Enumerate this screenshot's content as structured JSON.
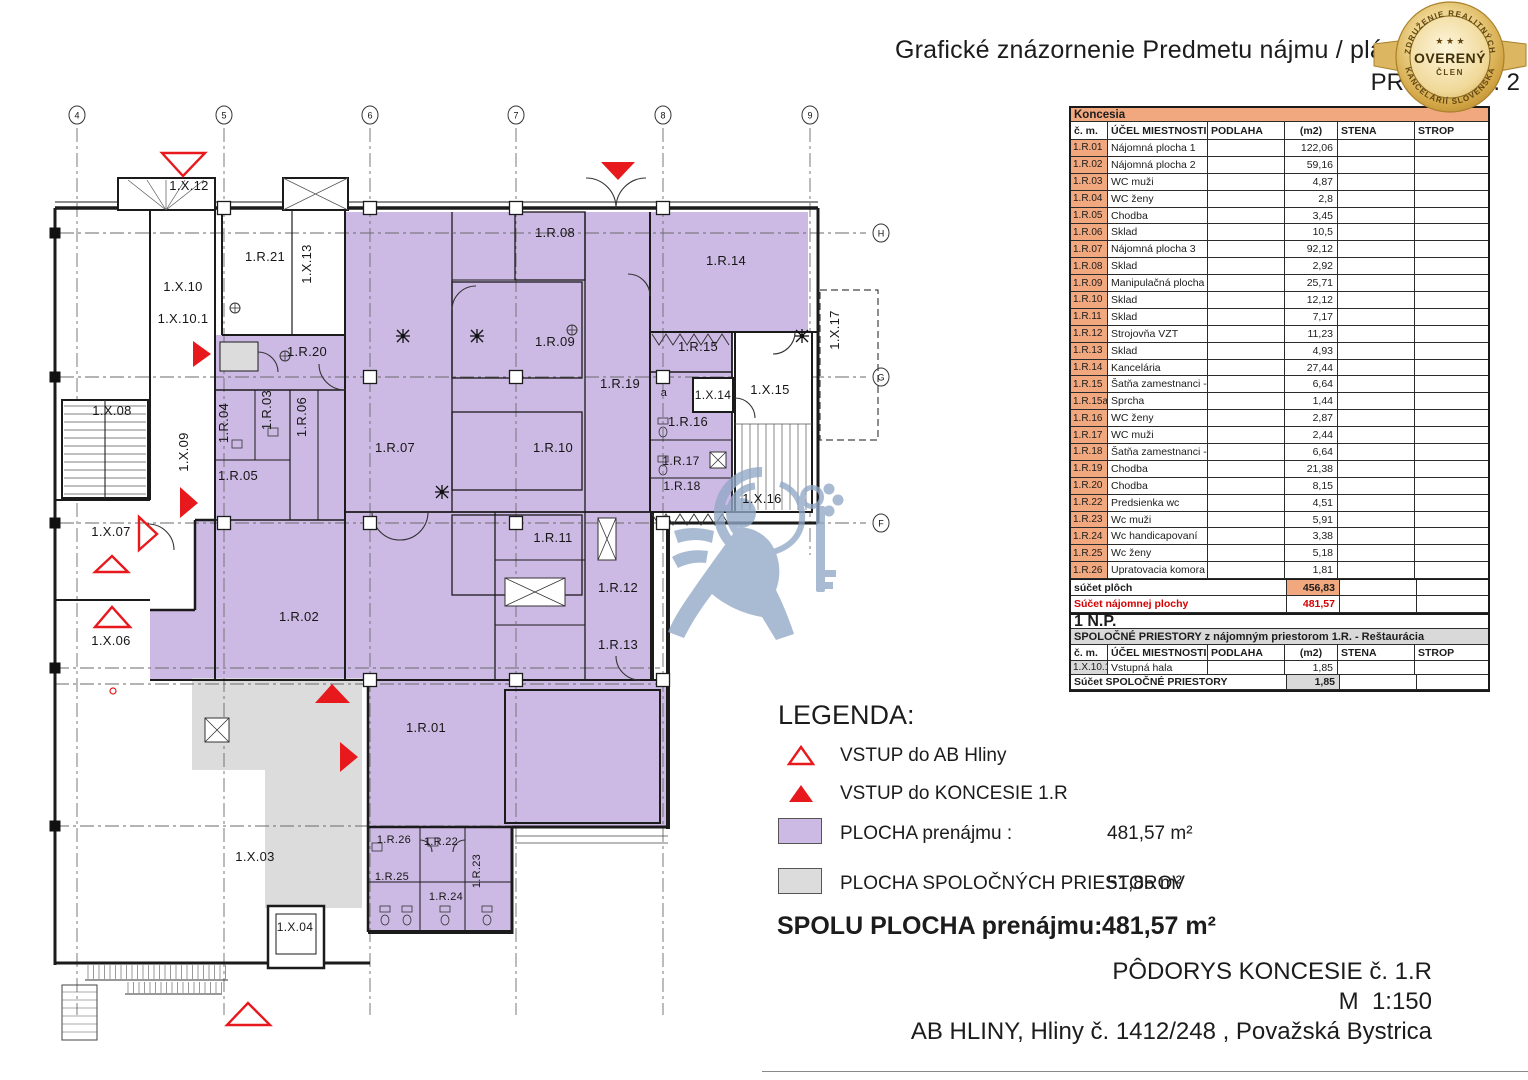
{
  "header": {
    "title": "Grafické znázornenie Predmetu nájmu / plán",
    "attachment": "PRÍLOHA č. 2"
  },
  "badge": {
    "arc_top": "ZDRUŽENIE REALITNÝCH",
    "arc_bottom": "KANCELÁRIÍ SLOVENSKA",
    "stars": "★ ★ ★",
    "label": "OVERENÝ",
    "sublabel": "ČLEN"
  },
  "area_table": {
    "section_title": "Koncesia",
    "columns": [
      "č. m.",
      "ÚČEL MIESTNOSTI",
      "PODLAHA",
      "(m2)",
      "STENA",
      "STROP"
    ],
    "rows": [
      [
        "1.R.01",
        "Nájomná plocha 1",
        "122,06"
      ],
      [
        "1.R.02",
        "Nájomná plocha 2",
        "59,16"
      ],
      [
        "1.R.03",
        "WC muži",
        "4,87"
      ],
      [
        "1.R.04",
        "WC ženy",
        "2,8"
      ],
      [
        "1.R.05",
        "Chodba",
        "3,45"
      ],
      [
        "1.R.06",
        "Sklad",
        "10,5"
      ],
      [
        "1.R.07",
        "Nájomná plocha 3",
        "92,12"
      ],
      [
        "1.R.08",
        "Sklad",
        "2,92"
      ],
      [
        "1.R.09",
        "Manipulačná plocha",
        "25,71"
      ],
      [
        "1.R.10",
        "Sklad",
        "12,12"
      ],
      [
        "1.R.11",
        "Sklad",
        "7,17"
      ],
      [
        "1.R.12",
        "Strojovňa VZT",
        "11,23"
      ],
      [
        "1.R.13",
        "Sklad",
        "4,93"
      ],
      [
        "1.R.14",
        "Kancelária",
        "27,44"
      ],
      [
        "1.R.15",
        "Šatňa zamestnanci - M",
        "6,64"
      ],
      [
        "1.R.15a",
        "Sprcha",
        "1,44"
      ],
      [
        "1.R.16",
        "WC ženy",
        "2,87"
      ],
      [
        "1.R.17",
        "WC muži",
        "2,44"
      ],
      [
        "1.R.18",
        "Šatňa zamestnanci - M",
        "6,64"
      ],
      [
        "1.R.19",
        "Chodba",
        "21,38"
      ],
      [
        "1.R.20",
        "Chodba",
        "8,15"
      ],
      [
        "1.R.22",
        "Predsienka wc",
        "4,51"
      ],
      [
        "1.R.23",
        "Wc muži",
        "5,91"
      ],
      [
        "1.R.24",
        "Wc handicapovaní",
        "3,38"
      ],
      [
        "1.R.25",
        "Wc ženy",
        "5,18"
      ],
      [
        "1.R.26",
        "Upratovacia komora",
        "1,81"
      ]
    ],
    "sum_area_label": "súčet plôch",
    "sum_area_value": "456,83",
    "sum_rent_label": "Súčet nájomnej plochy",
    "sum_rent_value": "481,57",
    "floor_label": "1 N.P.",
    "common_section_title": "SPOLOČNÉ PRIESTORY z nájomným priestorom 1.R. - Reštaurácia",
    "common_rows": [
      [
        "1.X.10.1",
        "Vstupná hala",
        "1,85"
      ]
    ],
    "common_sum_label": "Súčet SPOLOČNÉ PRIESTORY",
    "common_sum_value": "1,85"
  },
  "legend": {
    "title": "LEGENDA:",
    "items": [
      {
        "icon": "entrance-outline-triangle-icon",
        "label": "VSTUP do AB Hliny",
        "value": ""
      },
      {
        "icon": "entrance-filled-triangle-icon",
        "label": "VSTUP do KONCESIE 1.R",
        "value": ""
      },
      {
        "icon": "tenant-area-swatch",
        "label": "PLOCHA prenájmu :",
        "value": "481,57 m²"
      },
      {
        "icon": "common-area-swatch",
        "label": "PLOCHA SPOLOČNÝCH PRIESTOROV",
        "value": "51,85 m²"
      }
    ],
    "total_label": "SPOLU PLOCHA prenájmu:",
    "total_value": "481,57 m²"
  },
  "footer": {
    "line1": "PÔDORYS KONCESIE č. 1.R",
    "line2": "M  1:150",
    "line3": "AB HLINY, Hliny č. 1412/248 , Považská Bystrica"
  },
  "plan": {
    "colors": {
      "tenant_area": "#CDBAE4",
      "common_area": "#DCDCDC",
      "table_header_orange": "#F2A87E",
      "table_gray": "#D9D9D9",
      "highlight_red": "#E8191C",
      "table_sum_red": "#D40000",
      "watermark_blue": "#91A8C6"
    },
    "icons": [
      "entrance-triangle-icon",
      "ceiling-symbol-icon",
      "watermark-lion-key-icon",
      "door-swing-arc",
      "grid-marker"
    ],
    "grid_cols": [
      {
        "label": "4",
        "x": 77
      },
      {
        "label": "5",
        "x": 224
      },
      {
        "label": "6",
        "x": 370
      },
      {
        "label": "7",
        "x": 516
      },
      {
        "label": "8",
        "x": 663
      },
      {
        "label": "9",
        "x": 810
      }
    ],
    "grid_rows": [
      {
        "label": "H",
        "y": 233
      },
      {
        "label": "G",
        "y": 377
      },
      {
        "label": "F",
        "y": 523
      }
    ],
    "rooms": [
      {
        "t": "1.X.12",
        "x": 189,
        "y": 190
      },
      {
        "t": "1.R.21",
        "x": 265,
        "y": 261
      },
      {
        "t": "1.X.13",
        "x": 311,
        "y": 264,
        "r": -90
      },
      {
        "t": "1.X.10",
        "x": 183,
        "y": 291
      },
      {
        "t": "1.X.10.1",
        "x": 183,
        "y": 323
      },
      {
        "t": "1.R.20",
        "x": 307,
        "y": 356
      },
      {
        "t": "1.R.08",
        "x": 555,
        "y": 237
      },
      {
        "t": "1.R.14",
        "x": 726,
        "y": 265
      },
      {
        "t": "1.R.09",
        "x": 555,
        "y": 346
      },
      {
        "t": "1.R.15",
        "x": 698,
        "y": 351
      },
      {
        "t": "1.R.19",
        "x": 620,
        "y": 388
      },
      {
        "t": "a",
        "x": 664,
        "y": 396,
        "s": 11
      },
      {
        "t": "1.X.14",
        "x": 713,
        "y": 399,
        "s": 12
      },
      {
        "t": "1.X.15",
        "x": 770,
        "y": 394
      },
      {
        "t": "1.X.17",
        "x": 839,
        "y": 330,
        "r": -90
      },
      {
        "t": "1.R.16",
        "x": 688,
        "y": 426
      },
      {
        "t": "1.R.04",
        "x": 228,
        "y": 423,
        "r": -90
      },
      {
        "t": "1.R.03",
        "x": 271,
        "y": 410,
        "r": -90
      },
      {
        "t": "1.R.06",
        "x": 306,
        "y": 417,
        "r": -90
      },
      {
        "t": "1.X.09",
        "x": 188,
        "y": 452,
        "r": -90
      },
      {
        "t": "1.X.08",
        "x": 112,
        "y": 415
      },
      {
        "t": "1.R.07",
        "x": 395,
        "y": 452
      },
      {
        "t": "1.R.10",
        "x": 553,
        "y": 452
      },
      {
        "t": "1.R.17",
        "x": 681,
        "y": 465,
        "s": 12
      },
      {
        "t": "1.R.05",
        "x": 238,
        "y": 480
      },
      {
        "t": "1.R.18",
        "x": 682,
        "y": 490,
        "s": 12
      },
      {
        "t": "1.X.16",
        "x": 762,
        "y": 503
      },
      {
        "t": "1.X.07",
        "x": 111,
        "y": 536
      },
      {
        "t": "1.R.11",
        "x": 553,
        "y": 542
      },
      {
        "t": "1.R.12",
        "x": 618,
        "y": 592
      },
      {
        "t": "1.R.02",
        "x": 299,
        "y": 621
      },
      {
        "t": "1.X.06",
        "x": 111,
        "y": 645
      },
      {
        "t": "1.R.13",
        "x": 618,
        "y": 649
      },
      {
        "t": "1.R.01",
        "x": 426,
        "y": 732
      },
      {
        "t": "1.R.26",
        "x": 394,
        "y": 843,
        "s": 11
      },
      {
        "t": "1.R.22",
        "x": 441,
        "y": 845,
        "s": 11
      },
      {
        "t": "1.X.03",
        "x": 255,
        "y": 861
      },
      {
        "t": "1.R.23",
        "x": 480,
        "y": 871,
        "r": -90,
        "s": 11
      },
      {
        "t": "1.R.25",
        "x": 392,
        "y": 880,
        "s": 11
      },
      {
        "t": "1.R.24",
        "x": 446,
        "y": 900,
        "s": 11
      },
      {
        "t": "1.X.04",
        "x": 295,
        "y": 931,
        "s": 12
      }
    ]
  }
}
